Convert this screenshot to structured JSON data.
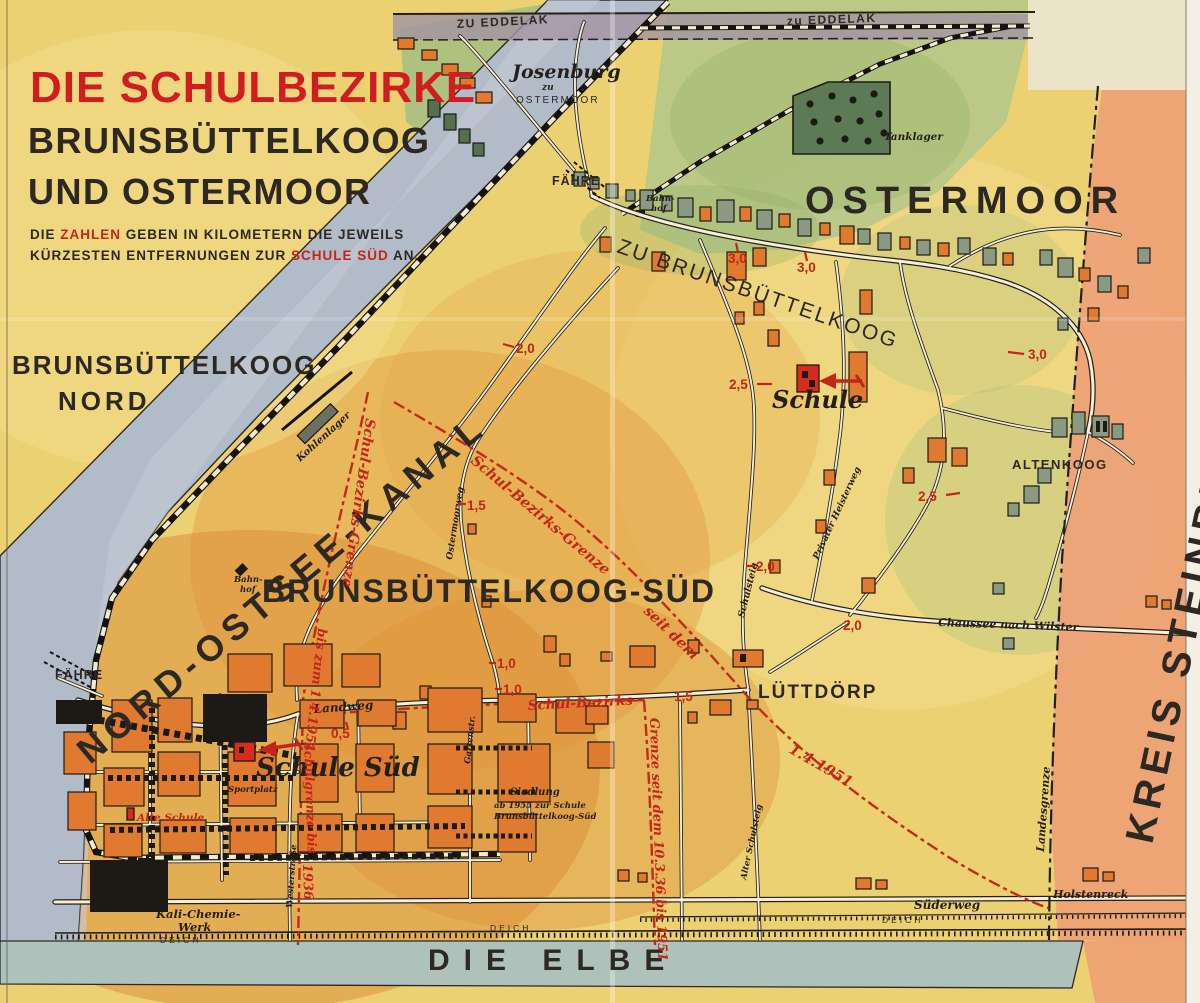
{
  "colors": {
    "paper": "#ecd173",
    "orange_wash": "#dd8f3a",
    "canal": "#b2bcc8",
    "elbe": "#aec2bb",
    "green": "#b3c789",
    "steinburg": "#eda077",
    "building_orange": "#df7a30",
    "building_green": "#8a9a82",
    "accent_red": "#c2261a",
    "title_red": "#cf1d20",
    "ink": "#2d2822"
  },
  "title": {
    "line1": "DIE SCHULBEZIRKE",
    "line2": "BRUNSBÜTTELKOOG",
    "line3": "UND OSTERMOOR"
  },
  "note": {
    "l1a": "DIE ",
    "l1b": "ZAHLEN",
    "l1c": " GEBEN IN KILOMETERN DIE JEWEILS",
    "l2a": "KÜRZESTEN ENTFERNUNGEN ZUR ",
    "l2b": "SCHULE SÜD",
    "l2c": " AN."
  },
  "regions": {
    "bk": "BRUNSBÜTTELKOOG",
    "nord": "NORD",
    "kanal": "NORD-OSTSEE-KANAL",
    "ostermoor": "OSTERMOOR",
    "bksued": "BRUNSBÜTTELKOOG-SÜD",
    "kreis": "KREIS STEINBURG",
    "elbe": "DIE ELBE"
  },
  "roads": {
    "eddelak_w": "ZU EDDELAK",
    "eddelak_e": "zu EDDELAK",
    "zu_bk": "ZU BRUNSBÜTTELKOOG",
    "landweg": "Landweg",
    "chaussee": "Chaussee nach Wilster",
    "suederweg": "Süderweg",
    "deich": "DEICH",
    "schulsteig": "Schulsteig",
    "alter_schulsteig": "Alter Schulsteig",
    "heisterweg": "Privater Heisterweg",
    "ostermoorweg": "Ostermoorweg",
    "gartenstr": "Gartenstr.",
    "westerstr": "Westerstraße",
    "landesgrenze": "Landesgrenze",
    "holstenreck": "Holstenreck"
  },
  "places": {
    "josenburg": "Josenburg",
    "josenburg_zu": "zu",
    "josenburg_om": "OSTERMOOR",
    "faehre_n": "FÄHRE",
    "faehre_s": "FÄHRE",
    "bahnhof_n1": "Bahn-",
    "bahnhof_n2": "hof",
    "bahnhof_s1": "Bahn-",
    "bahnhof_s2": "hof",
    "tanklager": "Tanklager",
    "kohlenlager": "Kohlenlager",
    "schule": "Schule",
    "schule_sued": "Schule Süd",
    "alte_schule": "Alte Schule",
    "sportplatz": "Sportplatz",
    "kali1": "Kali-Chemie-",
    "kali2": "Werk",
    "siedlung1": "Siedlung",
    "siedlung2": "ab 1955 zur Schule",
    "siedlung3": "Brunsbüttelkoog-Süd",
    "luettdoerp": "LÜTTDÖRP",
    "altenkoog": "ALTENKOOG"
  },
  "boundaries": {
    "alt1": "Schulgrenze bis",
    "alt2": "1936",
    "b51a": "Schul-Bezirks-Grenze",
    "b51b": "bis zum 1.4.1951",
    "neu_a": "Schul-Bezirks-Grenze",
    "neu_b": "seit dem",
    "neu_c": "1.4.1951",
    "b36a": "Schul-Bezirks-",
    "b36b": "Grenze seit dem 10.3.36 bis 1951"
  },
  "distances": [
    {
      "value": "3,0"
    },
    {
      "value": "3,0"
    },
    {
      "value": "3,0"
    },
    {
      "value": "2,5"
    },
    {
      "value": "2,5"
    },
    {
      "value": "2,0"
    },
    {
      "value": "2,0"
    },
    {
      "value": "2,0"
    },
    {
      "value": "1,5"
    },
    {
      "value": "1,5"
    },
    {
      "value": "1,0"
    },
    {
      "value": "1,0"
    },
    {
      "value": "0,5"
    }
  ]
}
